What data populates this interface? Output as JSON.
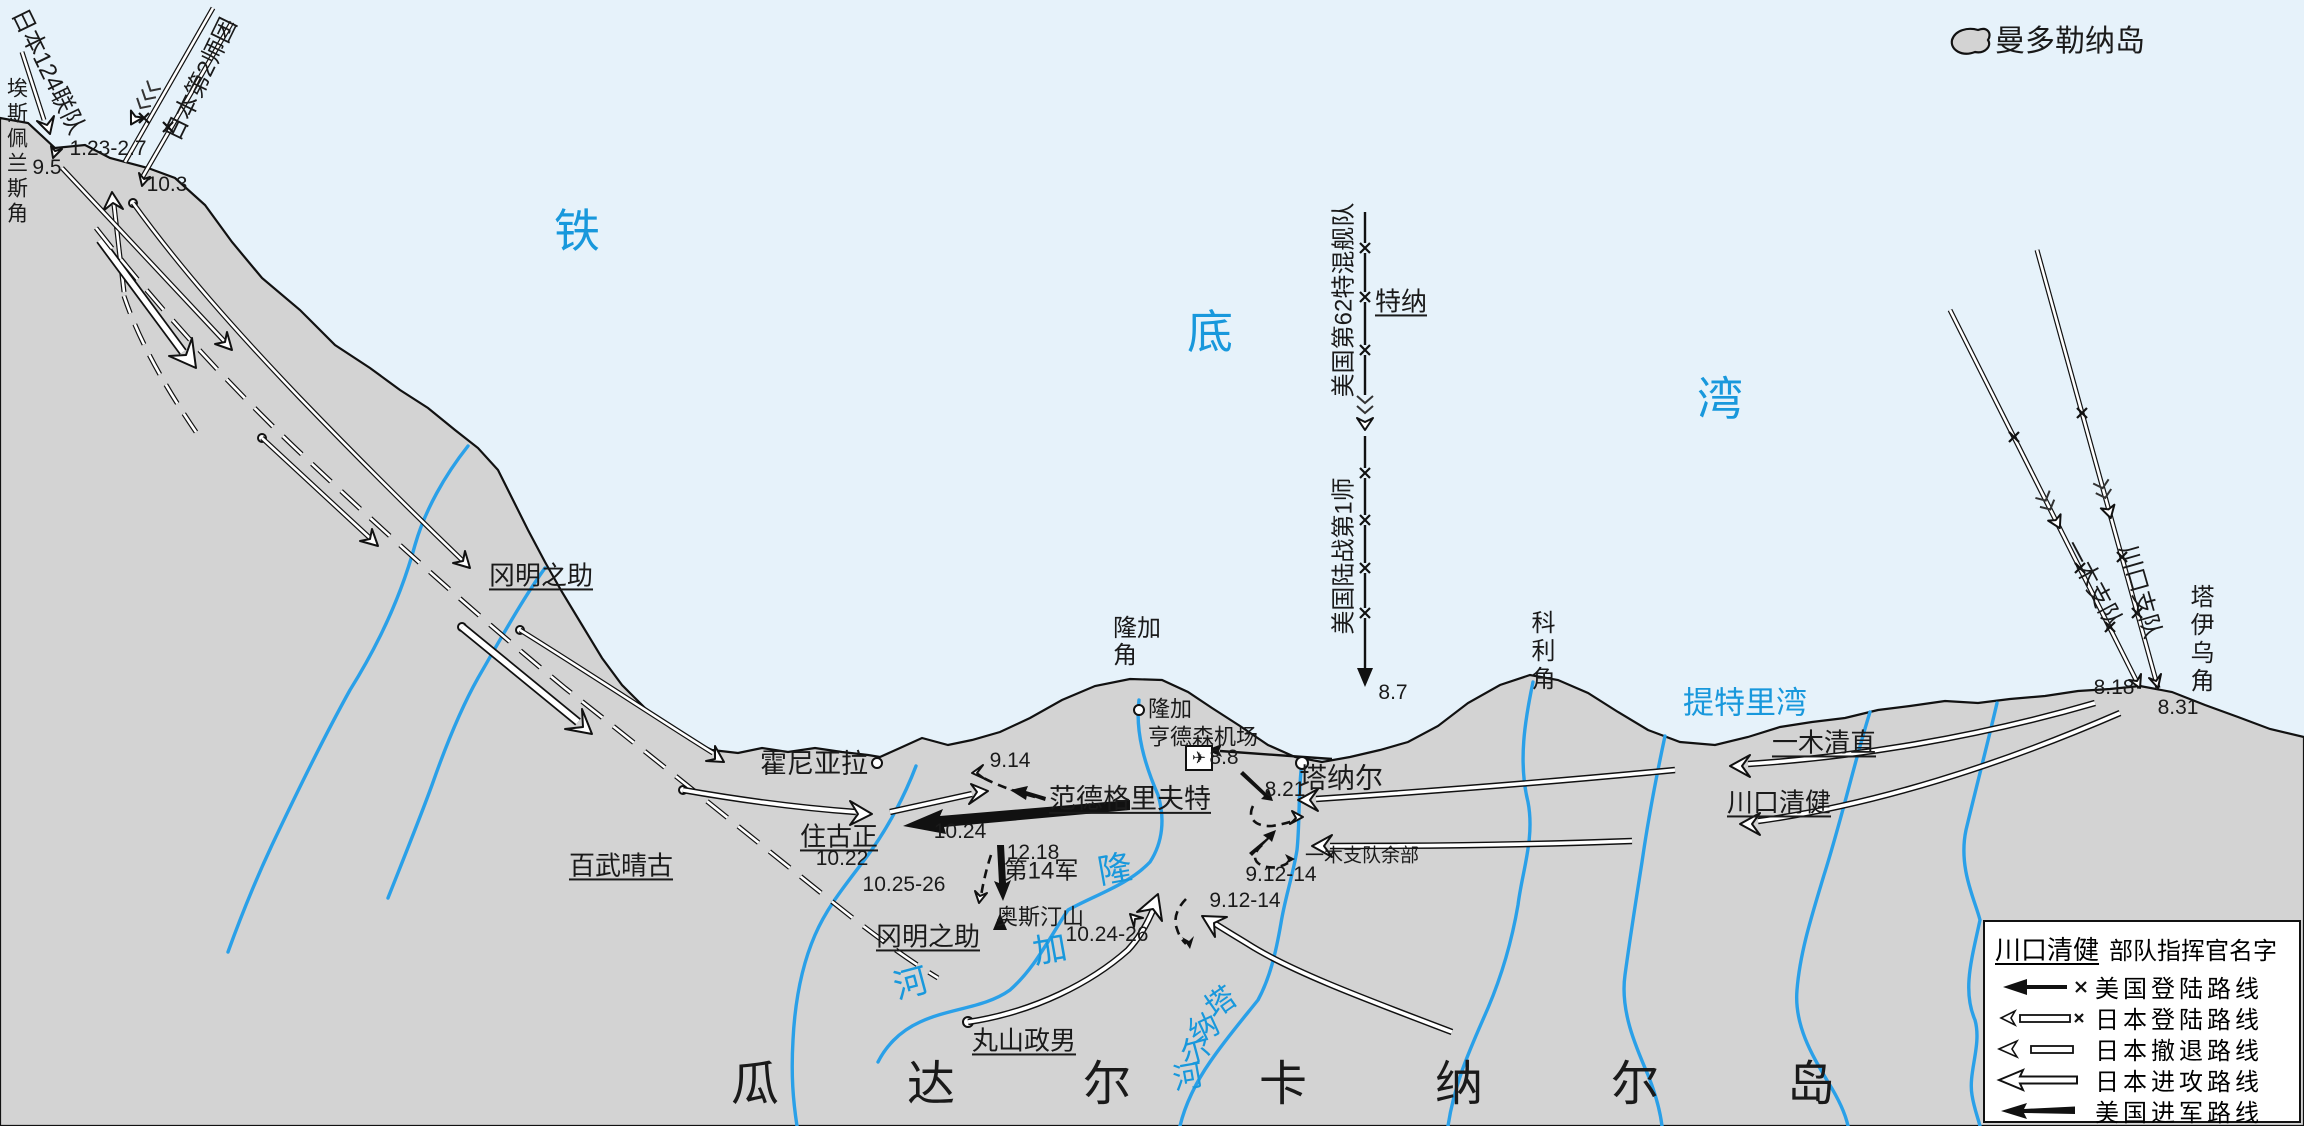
{
  "map": {
    "colors": {
      "sea": "#e6f2fa",
      "land": "#d3d3d3",
      "river": "#2aa0e8",
      "blue_text": "#1898dc"
    }
  },
  "labels": [
    {
      "name": "island-mandolena-label",
      "text": "曼多勒纳岛",
      "x": 2070,
      "y": 42,
      "size": 30
    },
    {
      "name": "bay-tiedi-char-1",
      "text": "铁",
      "x": 577,
      "y": 232,
      "size": 46,
      "color": "blue_text"
    },
    {
      "name": "bay-tiedi-char-2",
      "text": "底",
      "x": 1210,
      "y": 333,
      "size": 46,
      "color": "blue_text"
    },
    {
      "name": "bay-tiedi-char-3",
      "text": "湾",
      "x": 1720,
      "y": 400,
      "size": 46,
      "color": "blue_text"
    },
    {
      "name": "bay-tetere-label",
      "text": "提特里湾",
      "x": 1745,
      "y": 704,
      "size": 31,
      "color": "blue_text"
    },
    {
      "name": "cape-esperance-label",
      "text": "埃斯佩兰斯角",
      "x": 16,
      "y": 152,
      "size": 21,
      "vertical": true
    },
    {
      "name": "unit-japan-124-label",
      "text": "日本124联队",
      "x": 47,
      "y": 72,
      "size": 24,
      "rotate": 64
    },
    {
      "name": "unit-japan-2div-label",
      "text": "日本第2师团",
      "x": 202,
      "y": 80,
      "size": 24,
      "rotate": -64
    },
    {
      "name": "date-123-27",
      "text": "1.23-2.7",
      "x": 108,
      "y": 149,
      "size": 21
    },
    {
      "name": "date-95",
      "text": "9.5",
      "x": 47,
      "y": 168,
      "size": 21
    },
    {
      "name": "date-103",
      "text": "10.3",
      "x": 167,
      "y": 185,
      "size": 21
    },
    {
      "name": "commander-oka-nw",
      "text": "冈明之助",
      "x": 541,
      "y": 576,
      "size": 26,
      "underline": true
    },
    {
      "name": "commander-hyakutake",
      "text": "百武晴古",
      "x": 621,
      "y": 866,
      "size": 26,
      "underline": true
    },
    {
      "name": "city-honiara",
      "text": "霍尼亚拉",
      "x": 814,
      "y": 764,
      "size": 27
    },
    {
      "name": "commander-sumiyoshi",
      "text": "住古正",
      "x": 839,
      "y": 837,
      "size": 26,
      "underline": true
    },
    {
      "name": "date-1022",
      "text": "10.22",
      "x": 842,
      "y": 859,
      "size": 21
    },
    {
      "name": "date-1025-26",
      "text": "10.25-26",
      "x": 904,
      "y": 885,
      "size": 21
    },
    {
      "name": "commander-vandegrift",
      "text": "范德格里夫特",
      "x": 1130,
      "y": 799,
      "size": 27,
      "underline": true
    },
    {
      "name": "date-914",
      "text": "9.14",
      "x": 1010,
      "y": 761,
      "size": 21
    },
    {
      "name": "date-1024",
      "text": "10.24",
      "x": 960,
      "y": 832,
      "size": 21
    },
    {
      "name": "date-1218",
      "text": "12.18",
      "x": 1033,
      "y": 853,
      "size": 21
    },
    {
      "name": "unit-army-14",
      "text": "第14军",
      "x": 1041,
      "y": 872,
      "size": 24
    },
    {
      "name": "mount-austen-label",
      "text": "奥斯汀山",
      "x": 1040,
      "y": 918,
      "size": 22
    },
    {
      "name": "commander-oka-south",
      "text": "冈明之助",
      "x": 928,
      "y": 937,
      "size": 26,
      "underline": true
    },
    {
      "name": "date-1024-26",
      "text": "10.24-26",
      "x": 1107,
      "y": 935,
      "size": 21
    },
    {
      "name": "commander-maruyama",
      "text": "丸山政男",
      "x": 1024,
      "y": 1041,
      "size": 26,
      "underline": true
    },
    {
      "name": "date-912-14-east",
      "text": "9.12-14",
      "x": 1281,
      "y": 875,
      "size": 21
    },
    {
      "name": "date-912-14-south",
      "text": "9.12-14",
      "x": 1245,
      "y": 901,
      "size": 21
    },
    {
      "name": "unit-ichiki-remnant",
      "text": "一木支队余部",
      "x": 1362,
      "y": 856,
      "size": 19
    },
    {
      "name": "date-821",
      "text": "8.21",
      "x": 1285,
      "y": 790,
      "size": 21
    },
    {
      "name": "date-88",
      "text": "8.8",
      "x": 1224,
      "y": 758,
      "size": 21
    },
    {
      "name": "henderson-field-label",
      "text": "亨德森机场",
      "x": 1203,
      "y": 738,
      "size": 22
    },
    {
      "name": "airport-icon",
      "text": "✈",
      "x": 1199,
      "y": 758,
      "size": 17
    },
    {
      "name": "town-lunga",
      "text": "隆加",
      "x": 1170,
      "y": 710,
      "size": 22
    },
    {
      "name": "cape-lunga-label",
      "text": "隆加角",
      "x": 1113,
      "y": 643,
      "size": 24,
      "wrap": 2,
      "align": "left"
    },
    {
      "name": "town-tenaru",
      "text": "塔纳尔",
      "x": 1341,
      "y": 778,
      "size": 28
    },
    {
      "name": "date-87",
      "text": "8.7",
      "x": 1393,
      "y": 693,
      "size": 21
    },
    {
      "name": "cape-koli-label",
      "text": "科利角",
      "x": 1540,
      "y": 652,
      "size": 24,
      "vertical": true
    },
    {
      "name": "commander-ichiki",
      "text": "一木清直",
      "x": 1824,
      "y": 743,
      "size": 26,
      "underline": true
    },
    {
      "name": "commander-kawaguchi",
      "text": "川口清健",
      "x": 1779,
      "y": 803,
      "size": 26,
      "underline": true
    },
    {
      "name": "cape-taivu-label",
      "text": "塔伊乌角",
      "x": 2199,
      "y": 640,
      "size": 24,
      "vertical": true
    },
    {
      "name": "unit-ichiki-detachment",
      "text": "一木支队",
      "x": 2092,
      "y": 585,
      "size": 24,
      "rotate": 62
    },
    {
      "name": "unit-kawaguchi-detachment",
      "text": "川口支队",
      "x": 2139,
      "y": 592,
      "size": 24,
      "rotate": 74
    },
    {
      "name": "date-818",
      "text": "8.18",
      "x": 2114,
      "y": 688,
      "size": 21
    },
    {
      "name": "date-831",
      "text": "8.31",
      "x": 2178,
      "y": 708,
      "size": 21
    },
    {
      "name": "unit-us-tf62",
      "text": "美国第62特混舰队",
      "x": 1345,
      "y": 300,
      "size": 24,
      "rotate": -90
    },
    {
      "name": "commander-turner",
      "text": "特纳",
      "x": 1401,
      "y": 302,
      "size": 26,
      "underline": true
    },
    {
      "name": "unit-us-1st-marine-div",
      "text": "美国陆战第1师",
      "x": 1345,
      "y": 556,
      "size": 24,
      "rotate": -90
    },
    {
      "name": "island-guadalcanal-title",
      "text": "瓜达尔卡纳尔岛",
      "x": 731,
      "y": 1085,
      "size": 48,
      "letterSpacing": 128,
      "align": "left"
    },
    {
      "name": "river-lunga-char-1",
      "text": "隆",
      "x": 1115,
      "y": 870,
      "size": 34,
      "color": "blue_text",
      "rotate": -10
    },
    {
      "name": "river-lunga-char-2",
      "text": "加",
      "x": 1050,
      "y": 950,
      "size": 34,
      "color": "blue_text",
      "rotate": -10
    },
    {
      "name": "river-lunga-char-3",
      "text": "河",
      "x": 911,
      "y": 984,
      "size": 34,
      "color": "blue_text",
      "rotate": -15
    },
    {
      "name": "river-tenaru-char-1",
      "text": "塔",
      "x": 1221,
      "y": 1003,
      "size": 30,
      "color": "blue_text",
      "rotate": -35
    },
    {
      "name": "river-tenaru-char-2",
      "text": "纳",
      "x": 1204,
      "y": 1029,
      "size": 30,
      "color": "blue_text",
      "rotate": -25
    },
    {
      "name": "river-tenaru-char-3",
      "text": "尔",
      "x": 1196,
      "y": 1052,
      "size": 30,
      "color": "blue_text",
      "rotate": -15
    },
    {
      "name": "river-tenaru-char-4",
      "text": "河",
      "x": 1188,
      "y": 1078,
      "size": 30,
      "color": "blue_text",
      "rotate": -10
    }
  ],
  "legend": {
    "commander_example": "川口清健",
    "commander_desc": "部队指挥官名字",
    "items": [
      {
        "label": "美国登陆路线"
      },
      {
        "label": "日本登陆路线"
      },
      {
        "label": "日本撤退路线"
      },
      {
        "label": "日本进攻路线"
      },
      {
        "label": "美国进军路线"
      }
    ]
  }
}
